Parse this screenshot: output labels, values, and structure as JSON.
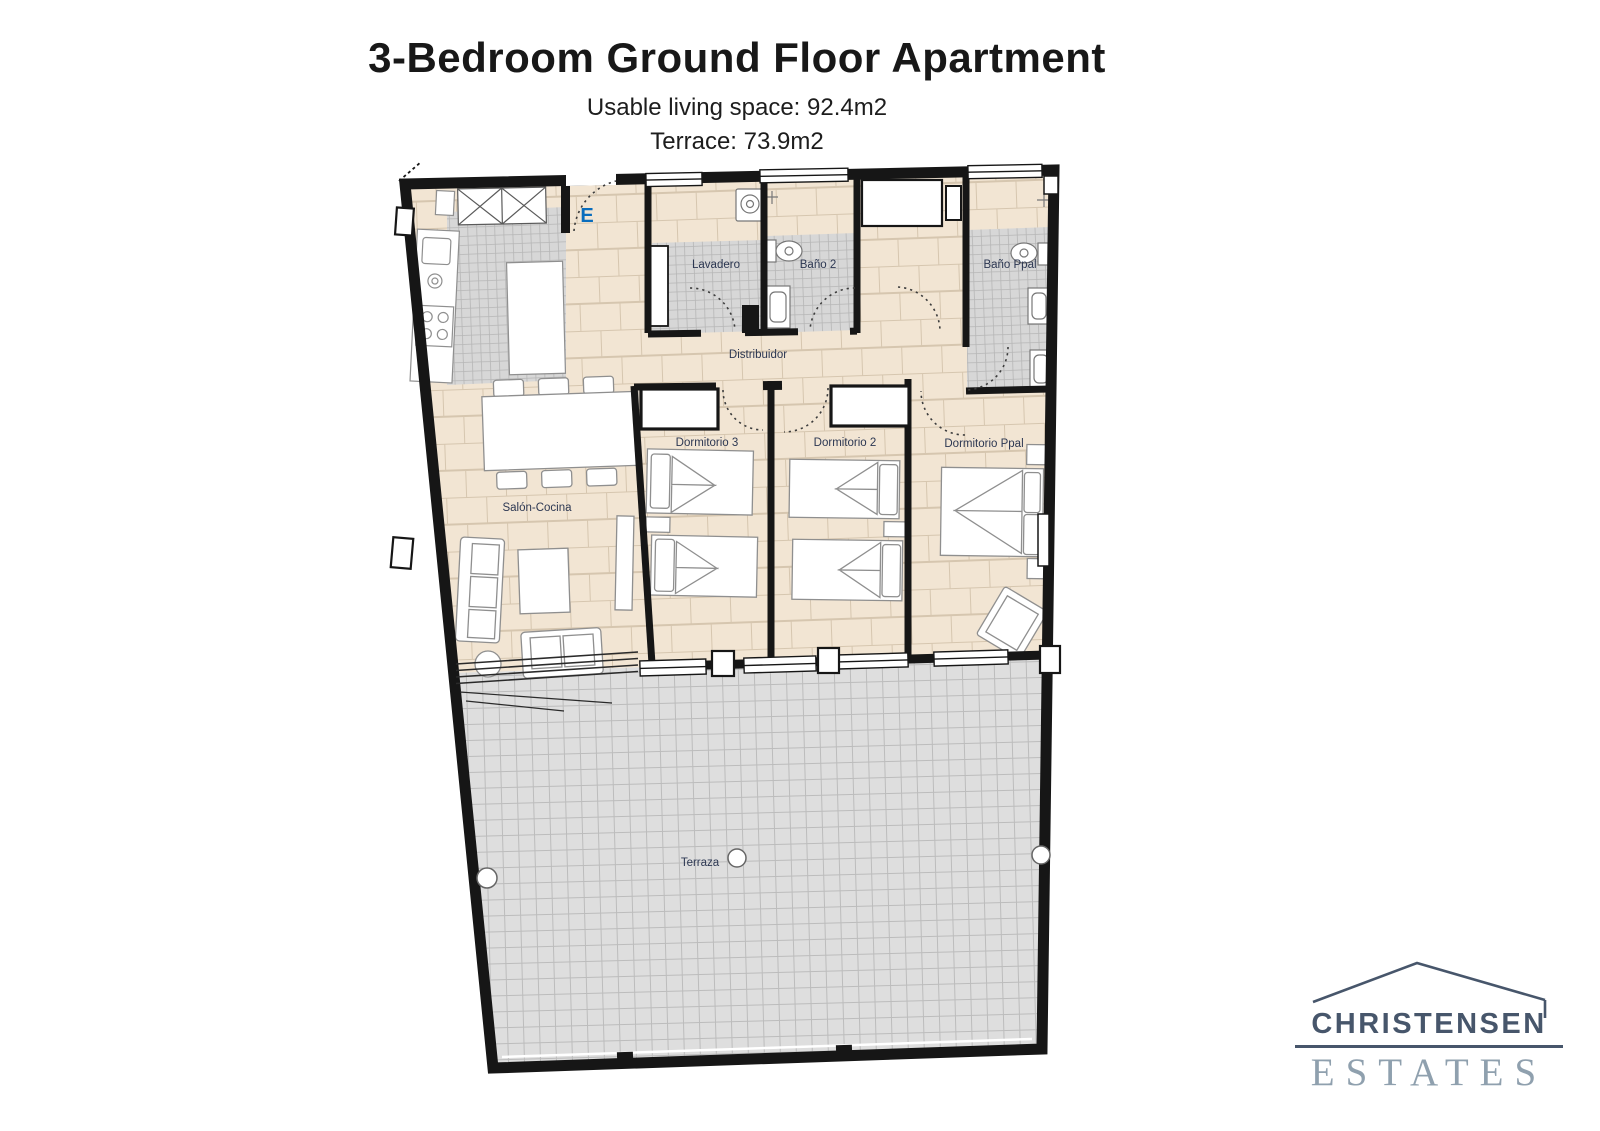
{
  "page": {
    "title": "3-Bedroom Ground Floor Apartment",
    "subtitle_living": "Usable living space: 92.4m2",
    "subtitle_terrace": "Terrace: 73.9m2"
  },
  "floorplan": {
    "rooms": {
      "lavadero": "Lavadero",
      "bano2": "Baño 2",
      "bano_ppal": "Baño Ppal",
      "distribuidor": "Distribuidor",
      "dormitorio3": "Dormitorio 3",
      "dormitorio2": "Dormitorio 2",
      "dormitorio_ppal": "Dormitorio Ppal",
      "salon_cocina": "Salón-Cocina",
      "terraza": "Terraza"
    },
    "entrance_label": "E",
    "colors": {
      "floor_tile": "#f2e5d3",
      "wet_room_tile": "#d7d7d7",
      "terrace_tile": "#dedede",
      "wall": "#161616",
      "room_label": "#2c3752",
      "entrance_blue": "#0a6dbd"
    }
  },
  "logo": {
    "name_line": "CHRISTENSEN",
    "estates_line": "ESTATES",
    "name_color": "#47566b",
    "estates_color": "#8fa0ae"
  }
}
